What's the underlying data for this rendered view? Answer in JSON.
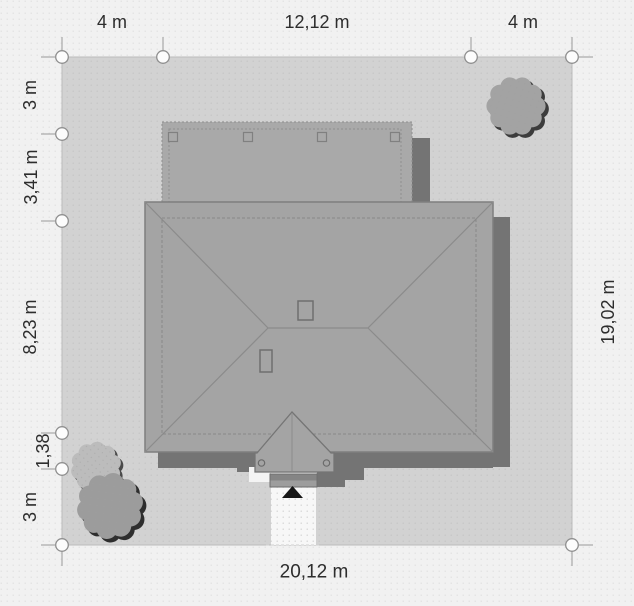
{
  "page": {
    "type": "architectural site plan, roof top view"
  },
  "dimensions": {
    "top": [
      {
        "label": "4 m"
      },
      {
        "label": "12,12 m"
      },
      {
        "label": "4 m"
      }
    ],
    "left": [
      {
        "label": "3 m"
      },
      {
        "label": "3,41 m"
      },
      {
        "label": "8,23 m"
      },
      {
        "label": "1,38"
      },
      {
        "label": "3 m"
      }
    ],
    "right": [
      {
        "label": "19,02 m"
      }
    ],
    "bottom": [
      {
        "label": "20,12 m"
      }
    ]
  },
  "colors": {
    "background": "#f1f1f1",
    "plot": "#d2d2d2",
    "building": "#a4a4a4",
    "shadow": "#747474",
    "walkway": "#f7f7f7",
    "text": "#2d2d2d"
  }
}
